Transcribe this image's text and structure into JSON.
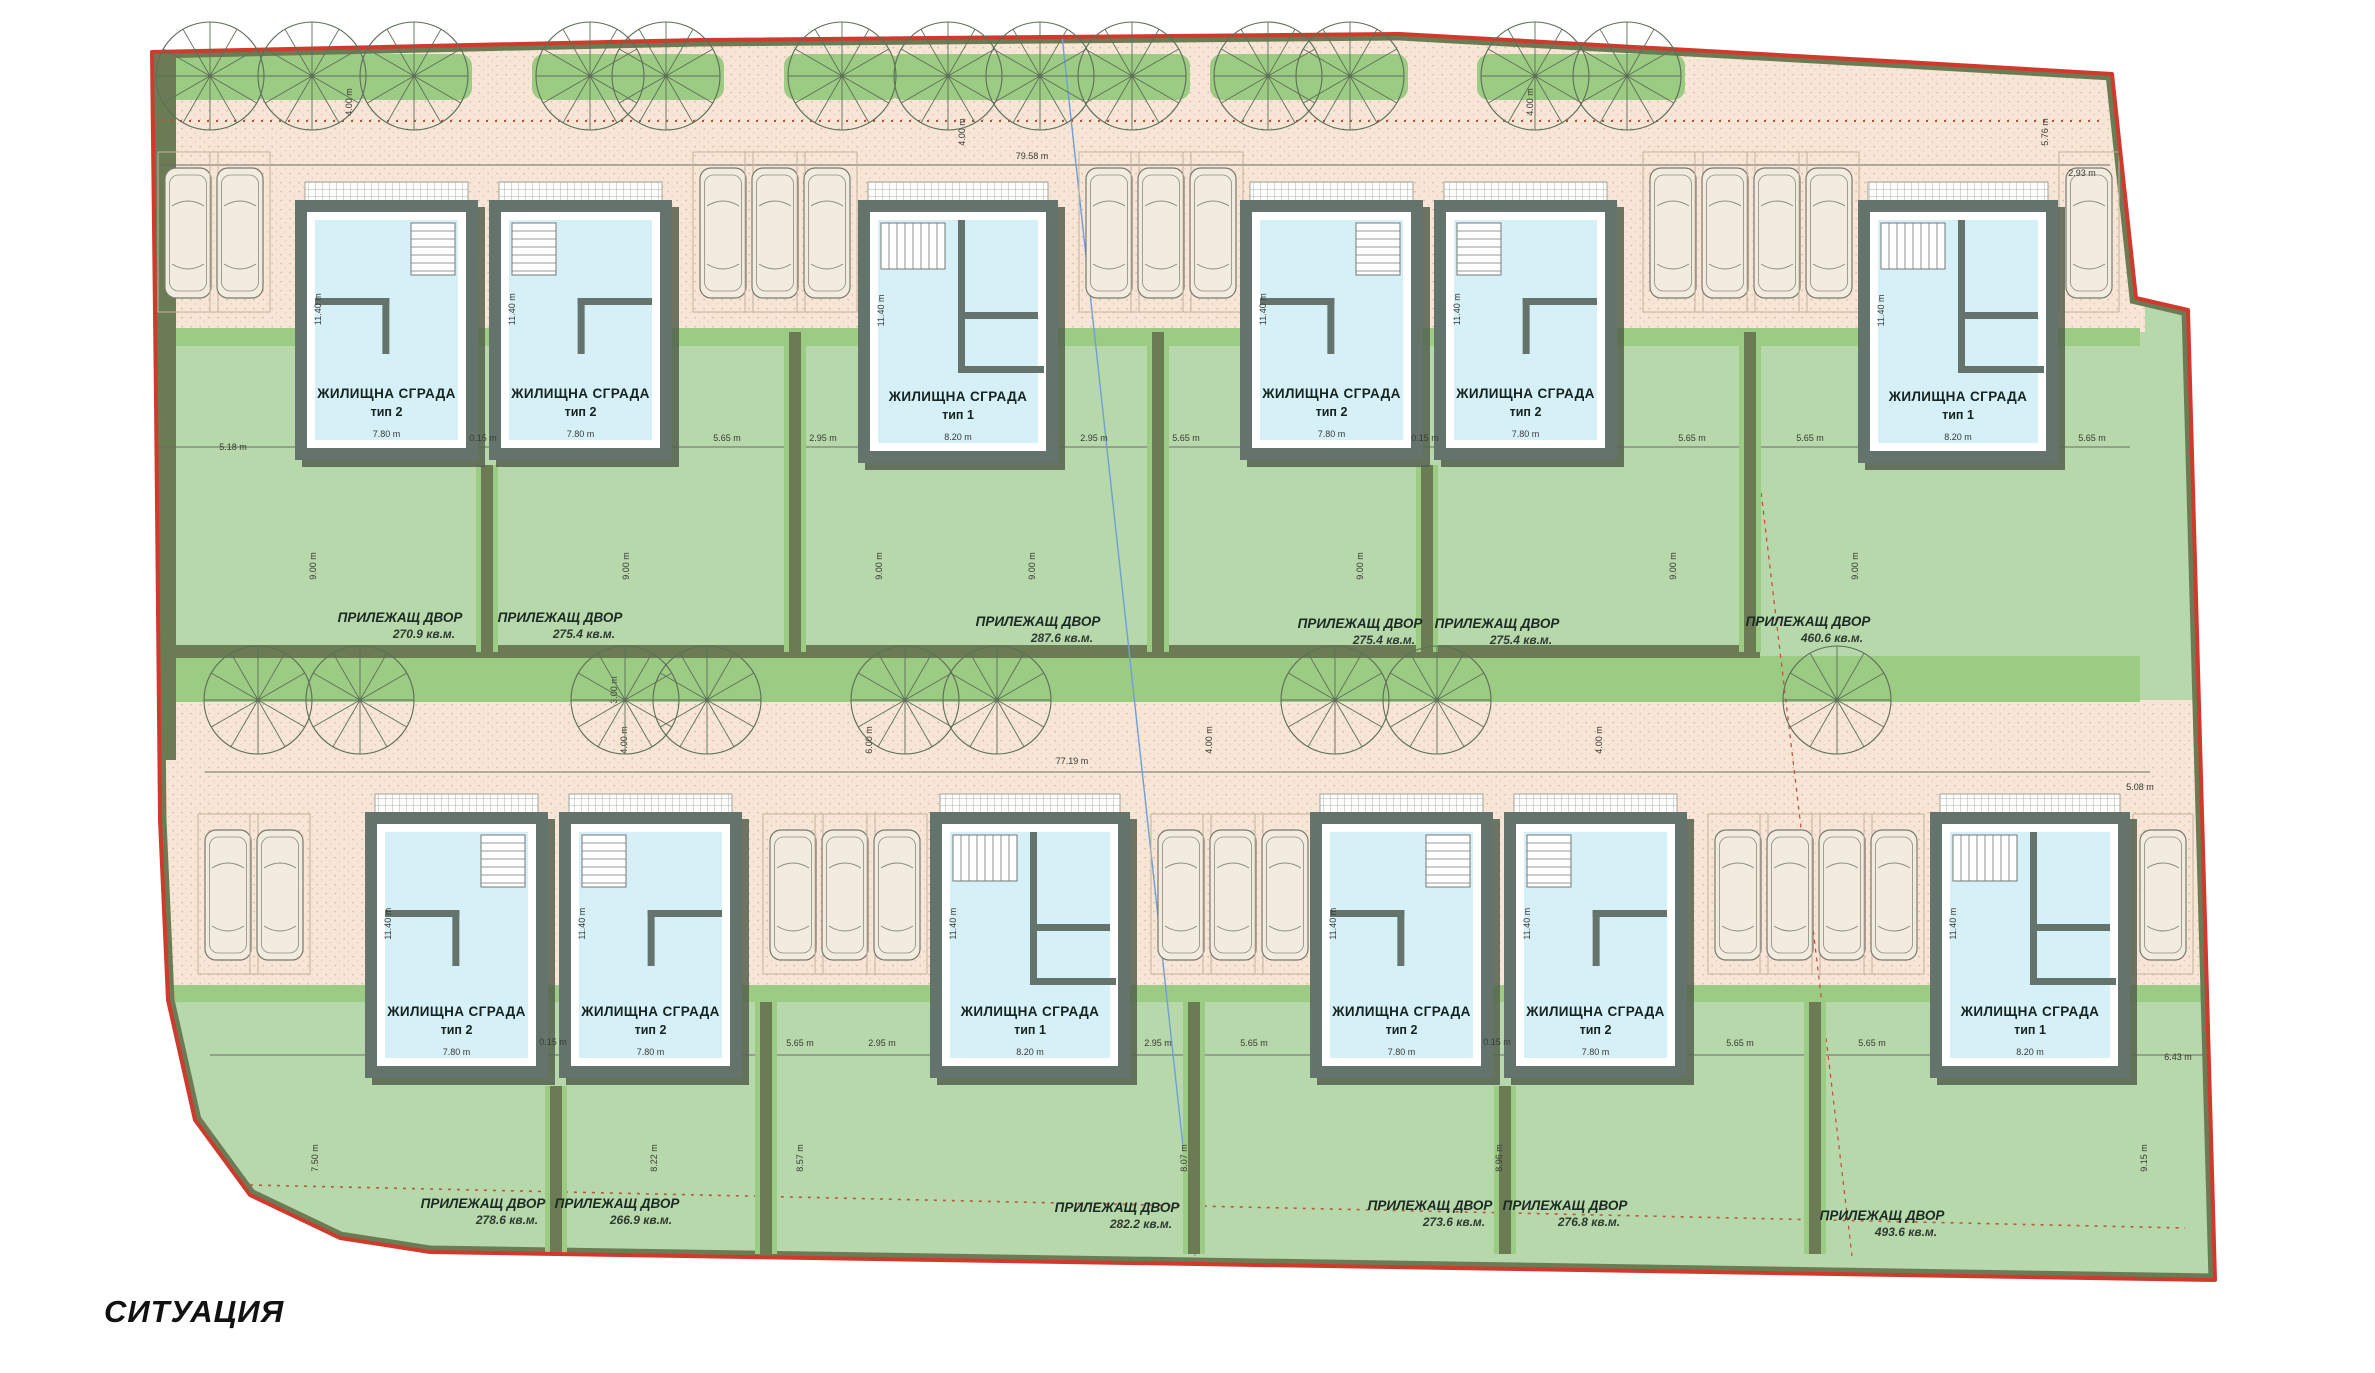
{
  "title": "СИТУАЦИЯ",
  "buildings": [
    {
      "name": "ЖИЛИЩНА СГРАДА",
      "type": "тип 2",
      "width": "7.80 m",
      "depth": "11.40 m",
      "x": 295,
      "y": 200,
      "w": 183,
      "h": 260,
      "plan": "l"
    },
    {
      "name": "ЖИЛИЩНА СГРАДА",
      "type": "тип 2",
      "width": "7.80 m",
      "depth": "11.40 m",
      "x": 489,
      "y": 200,
      "w": 183,
      "h": 260,
      "plan": "r"
    },
    {
      "name": "ЖИЛИЩНА СГРАДА",
      "type": "тип 1",
      "width": "8.20 m",
      "depth": "11.40 m",
      "x": 858,
      "y": 200,
      "w": 200,
      "h": 263,
      "plan": "s"
    },
    {
      "name": "ЖИЛИЩНА СГРАДА",
      "type": "тип 2",
      "width": "7.80 m",
      "depth": "11.40 m",
      "x": 1240,
      "y": 200,
      "w": 183,
      "h": 260,
      "plan": "l"
    },
    {
      "name": "ЖИЛИЩНА СГРАДА",
      "type": "тип 2",
      "width": "7.80 m",
      "depth": "11.40 m",
      "x": 1434,
      "y": 200,
      "w": 183,
      "h": 260,
      "plan": "r"
    },
    {
      "name": "ЖИЛИЩНА СГРАДА",
      "type": "тип 1",
      "width": "8.20 m",
      "depth": "11.40 m",
      "x": 1858,
      "y": 200,
      "w": 200,
      "h": 263,
      "plan": "s"
    },
    {
      "name": "ЖИЛИЩНА СГРАДА",
      "type": "тип 2",
      "width": "7.80 m",
      "depth": "11.40 m",
      "x": 365,
      "y": 812,
      "w": 183,
      "h": 266,
      "plan": "l"
    },
    {
      "name": "ЖИЛИЩНА СГРАДА",
      "type": "тип 2",
      "width": "7.80 m",
      "depth": "11.40 m",
      "x": 559,
      "y": 812,
      "w": 183,
      "h": 266,
      "plan": "r"
    },
    {
      "name": "ЖИЛИЩНА СГРАДА",
      "type": "тип 1",
      "width": "8.20 m",
      "depth": "11.40 m",
      "x": 930,
      "y": 812,
      "w": 200,
      "h": 266,
      "plan": "s"
    },
    {
      "name": "ЖИЛИЩНА СГРАДА",
      "type": "тип 2",
      "width": "7.80 m",
      "depth": "11.40 m",
      "x": 1310,
      "y": 812,
      "w": 183,
      "h": 266,
      "plan": "l"
    },
    {
      "name": "ЖИЛИЩНА СГРАДА",
      "type": "тип 2",
      "width": "7.80 m",
      "depth": "11.40 m",
      "x": 1504,
      "y": 812,
      "w": 183,
      "h": 266,
      "plan": "r"
    },
    {
      "name": "ЖИЛИЩНА СГРАДА",
      "type": "тип 1",
      "width": "8.20 m",
      "depth": "11.40 m",
      "x": 1930,
      "y": 812,
      "w": 200,
      "h": 266,
      "plan": "s"
    }
  ],
  "yards": [
    {
      "label": "ПРИЛЕЖАЩ ДВОР",
      "area": "270.9 кв.м.",
      "x": 400,
      "y": 622
    },
    {
      "label": "ПРИЛЕЖАЩ ДВОР",
      "area": "275.4 кв.м.",
      "x": 560,
      "y": 622
    },
    {
      "label": "ПРИЛЕЖАЩ ДВОР",
      "area": "287.6 кв.м.",
      "x": 1038,
      "y": 626
    },
    {
      "label": "ПРИЛЕЖАЩ ДВОР",
      "area": "275.4 кв.м.",
      "x": 1360,
      "y": 628
    },
    {
      "label": "ПРИЛЕЖАЩ ДВОР",
      "area": "275.4 кв.м.",
      "x": 1497,
      "y": 628
    },
    {
      "label": "ПРИЛЕЖАЩ ДВОР",
      "area": "460.6 кв.м.",
      "x": 1808,
      "y": 626
    },
    {
      "label": "ПРИЛЕЖАЩ ДВОР",
      "area": "278.6 кв.м.",
      "x": 483,
      "y": 1208
    },
    {
      "label": "ПРИЛЕЖАЩ ДВОР",
      "area": "266.9 кв.м.",
      "x": 617,
      "y": 1208
    },
    {
      "label": "ПРИЛЕЖАЩ ДВОР",
      "area": "282.2 кв.м.",
      "x": 1117,
      "y": 1212
    },
    {
      "label": "ПРИЛЕЖАЩ ДВОР",
      "area": "273.6 кв.м.",
      "x": 1430,
      "y": 1210
    },
    {
      "label": "ПРИЛЕЖАЩ ДВОР",
      "area": "276.8 кв.м.",
      "x": 1565,
      "y": 1210
    },
    {
      "label": "ПРИЛЕЖАЩ ДВОР",
      "area": "493.6 кв.м.",
      "x": 1882,
      "y": 1220
    }
  ],
  "dims": [
    {
      "text": "5.18 m",
      "x": 233,
      "y": 450,
      "rot": 0
    },
    {
      "text": "0.15 m",
      "x": 483,
      "y": 441,
      "rot": 0
    },
    {
      "text": "5.65 m",
      "x": 727,
      "y": 441,
      "rot": 0
    },
    {
      "text": "2.95 m",
      "x": 823,
      "y": 441,
      "rot": 0
    },
    {
      "text": "2.95 m",
      "x": 1094,
      "y": 441,
      "rot": 0
    },
    {
      "text": "5.65 m",
      "x": 1186,
      "y": 441,
      "rot": 0
    },
    {
      "text": "0.15 m",
      "x": 1425,
      "y": 441,
      "rot": 0
    },
    {
      "text": "5.65 m",
      "x": 1692,
      "y": 441,
      "rot": 0
    },
    {
      "text": "5.65 m",
      "x": 1810,
      "y": 441,
      "rot": 0
    },
    {
      "text": "5.65 m",
      "x": 2092,
      "y": 441,
      "rot": 0
    },
    {
      "text": "2.93 m",
      "x": 2082,
      "y": 176,
      "rot": 0
    },
    {
      "text": "79.58 m",
      "x": 1032,
      "y": 159,
      "rot": 0
    },
    {
      "text": "4.00 m",
      "x": 352,
      "y": 102,
      "rot": -90
    },
    {
      "text": "4.00 m",
      "x": 965,
      "y": 132,
      "rot": -90
    },
    {
      "text": "4.00 m",
      "x": 1533,
      "y": 102,
      "rot": -90
    },
    {
      "text": "5.76 m",
      "x": 2048,
      "y": 132,
      "rot": -90
    },
    {
      "text": "9.00 m",
      "x": 316,
      "y": 566,
      "rot": -90
    },
    {
      "text": "9.00 m",
      "x": 629,
      "y": 566,
      "rot": -90
    },
    {
      "text": "9.00 m",
      "x": 882,
      "y": 566,
      "rot": -90
    },
    {
      "text": "9.00 m",
      "x": 1035,
      "y": 566,
      "rot": -90
    },
    {
      "text": "9.00 m",
      "x": 1363,
      "y": 566,
      "rot": -90
    },
    {
      "text": "9.00 m",
      "x": 1676,
      "y": 566,
      "rot": -90
    },
    {
      "text": "9.00 m",
      "x": 1858,
      "y": 566,
      "rot": -90
    },
    {
      "text": "77.19 m",
      "x": 1072,
      "y": 764,
      "rot": 0
    },
    {
      "text": "4.00 m",
      "x": 627,
      "y": 740,
      "rot": -90
    },
    {
      "text": "6.00 m",
      "x": 872,
      "y": 740,
      "rot": -90
    },
    {
      "text": "4.00 m",
      "x": 1212,
      "y": 740,
      "rot": -90
    },
    {
      "text": "4.00 m",
      "x": 1602,
      "y": 740,
      "rot": -90
    },
    {
      "text": "3.00 m",
      "x": 617,
      "y": 690,
      "rot": -90
    },
    {
      "text": "5.08 m",
      "x": 2140,
      "y": 790,
      "rot": 0
    },
    {
      "text": "0.15 m",
      "x": 553,
      "y": 1045,
      "rot": 0
    },
    {
      "text": "5.65 m",
      "x": 800,
      "y": 1046,
      "rot": 0
    },
    {
      "text": "2.95 m",
      "x": 882,
      "y": 1046,
      "rot": 0
    },
    {
      "text": "2.95 m",
      "x": 1158,
      "y": 1046,
      "rot": 0
    },
    {
      "text": "5.65 m",
      "x": 1254,
      "y": 1046,
      "rot": 0
    },
    {
      "text": "0.15 m",
      "x": 1497,
      "y": 1045,
      "rot": 0
    },
    {
      "text": "5.65 m",
      "x": 1740,
      "y": 1046,
      "rot": 0
    },
    {
      "text": "5.65 m",
      "x": 1872,
      "y": 1046,
      "rot": 0
    },
    {
      "text": "6.43 m",
      "x": 2178,
      "y": 1060,
      "rot": 0
    },
    {
      "text": "6.74 m",
      "x": 152,
      "y": 1038,
      "rot": 0
    },
    {
      "text": "7.50 m",
      "x": 318,
      "y": 1158,
      "rot": -90
    },
    {
      "text": "8.22 m",
      "x": 657,
      "y": 1158,
      "rot": -90
    },
    {
      "text": "8.57 m",
      "x": 803,
      "y": 1158,
      "rot": -90
    },
    {
      "text": "8.07 m",
      "x": 1187,
      "y": 1158,
      "rot": -90
    },
    {
      "text": "8.96 m",
      "x": 1502,
      "y": 1158,
      "rot": -90
    },
    {
      "text": "9.15 m",
      "x": 2147,
      "y": 1158,
      "rot": -90
    }
  ],
  "colors": {
    "boundary": "#cf3a2c",
    "road": "#f7e5d6",
    "road_dot": "#d8bca7",
    "grass": "#b6d8aa",
    "grass_bright": "#9ccb83",
    "hedge": "#6b7c55",
    "wall": "#64746d",
    "interior": "#d6f0f7",
    "shadow": "#55624e",
    "dashed_red": "#c24b38",
    "line_blue": "#6f9fd6"
  }
}
